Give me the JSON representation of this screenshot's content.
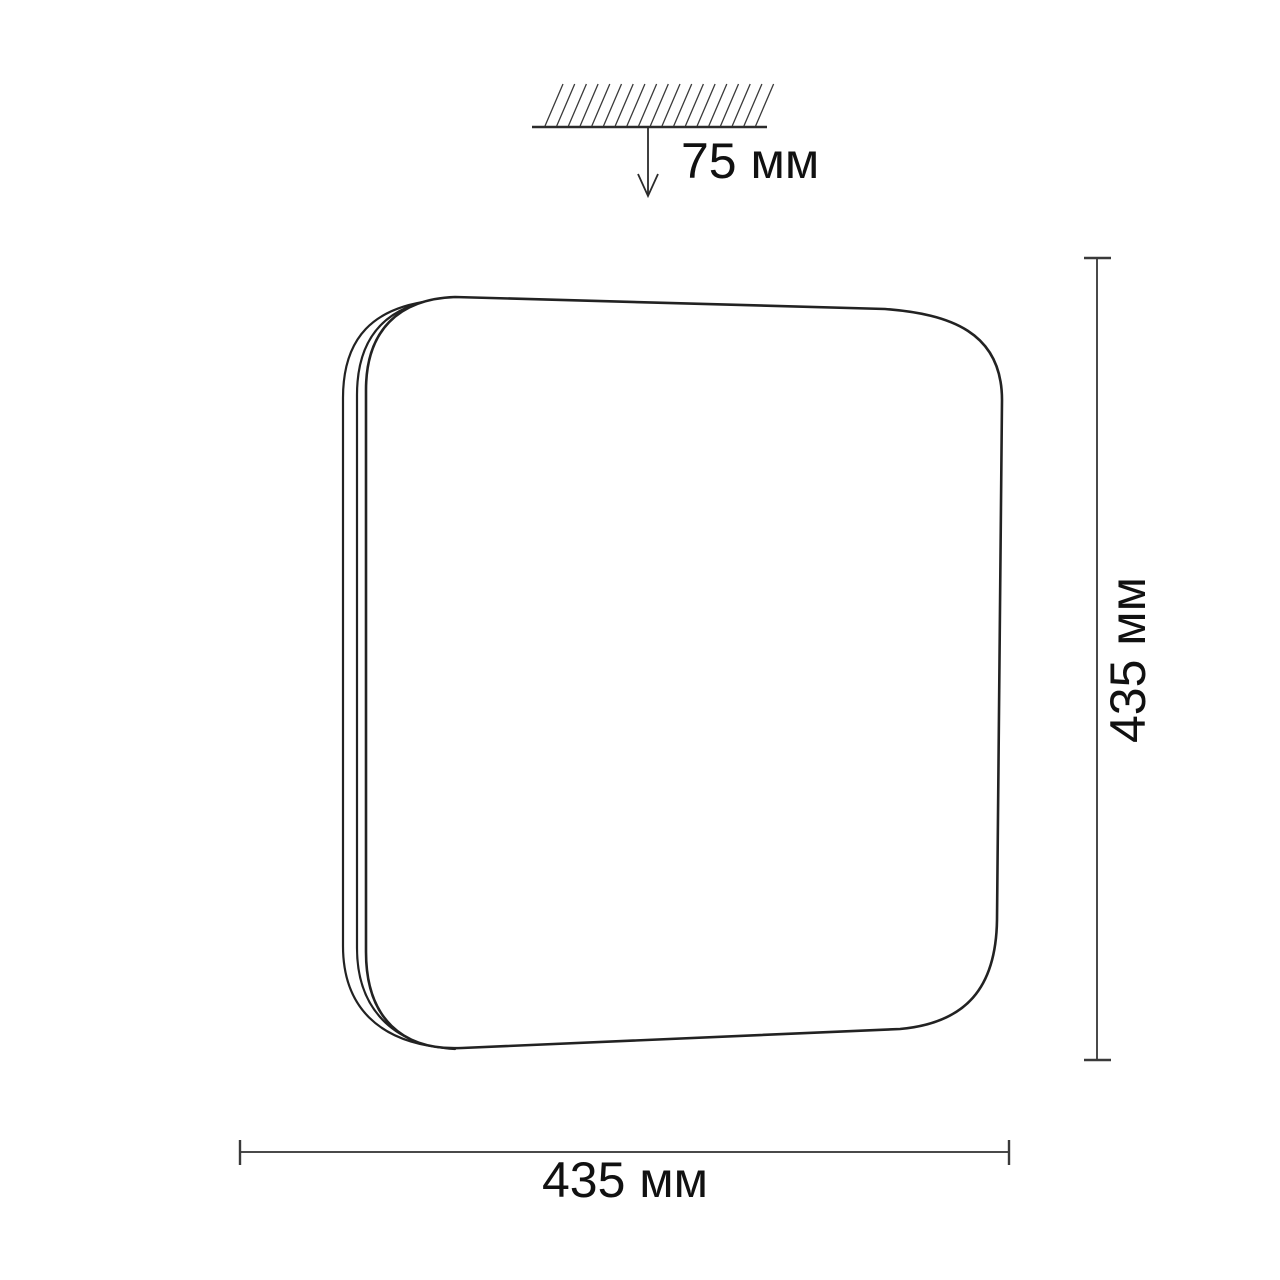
{
  "figure": {
    "description_labels": {
      "mount_offset": "75 мм",
      "height": "435 мм",
      "width": "435 мм"
    },
    "colors": {
      "background": "#ffffff",
      "outline": "#222222",
      "dimension": "#4a4a4a",
      "text": "#111111"
    }
  }
}
